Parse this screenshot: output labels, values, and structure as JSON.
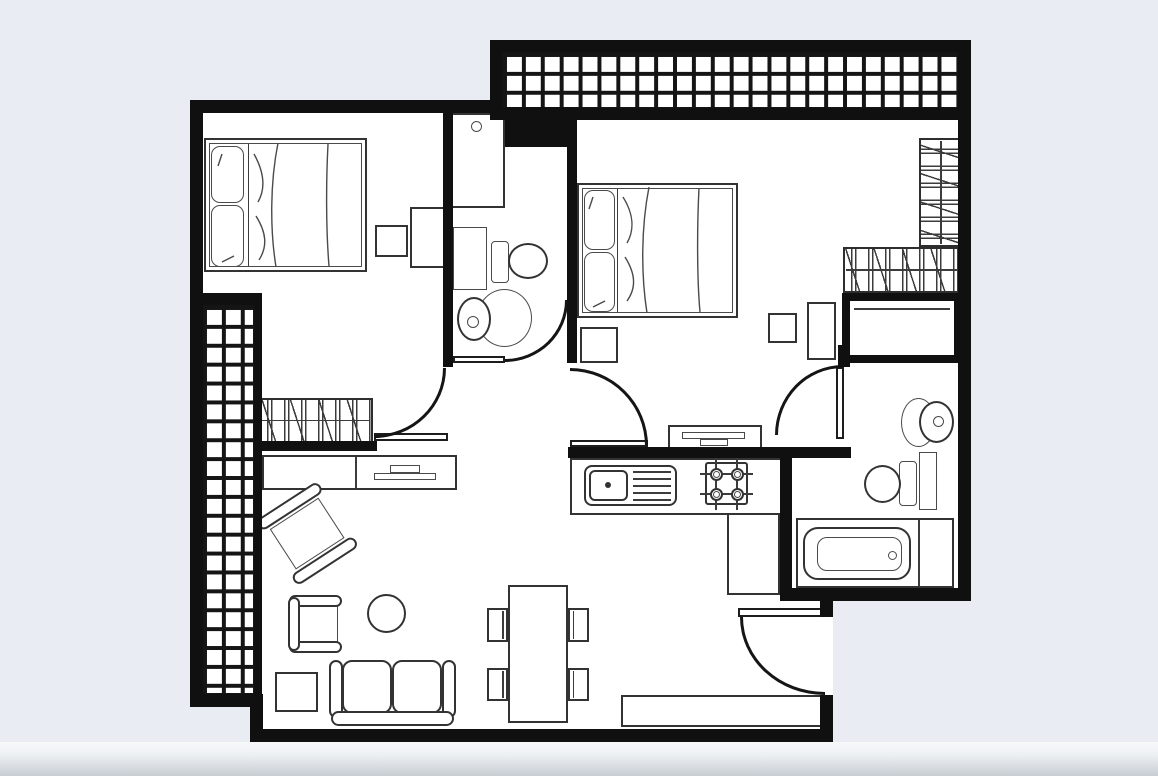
{
  "canvas": {
    "width": 1158,
    "height": 776,
    "background_color": "#e9edf3",
    "floor_color": "#ffffff",
    "wall_color": "#101010",
    "furniture_line_color": "#3c3c3c",
    "bottom_band": [
      0,
      742,
      1158,
      34
    ]
  },
  "rooms": [
    "bedroom-left",
    "bedroom-right",
    "bathroom",
    "wc",
    "kitchen",
    "living-dining-room",
    "hall",
    "balcony-top",
    "balcony-left",
    "entrance"
  ],
  "plan": {
    "floor_rects": [
      [
        190,
        100,
        781,
        501
      ],
      [
        490,
        40,
        481,
        80
      ],
      [
        190,
        601,
        643,
        106
      ],
      [
        250,
        707,
        583,
        35
      ]
    ],
    "walls": [
      [
        190,
        100,
        312,
        13
      ],
      [
        190,
        100,
        13,
        607
      ],
      [
        190,
        694,
        73,
        13
      ],
      [
        250,
        707,
        13,
        35
      ],
      [
        250,
        729,
        583,
        13
      ],
      [
        820,
        695,
        13,
        47
      ],
      [
        820,
        601,
        13,
        16
      ],
      [
        780,
        588,
        191,
        13
      ],
      [
        780,
        451,
        12,
        150
      ],
      [
        958,
        40,
        13,
        561
      ],
      [
        490,
        40,
        481,
        12
      ],
      [
        490,
        40,
        12,
        80
      ],
      [
        502,
        108,
        456,
        12
      ],
      [
        443,
        113,
        10,
        254
      ],
      [
        567,
        113,
        10,
        250
      ],
      [
        259,
        441,
        118,
        10
      ],
      [
        568,
        447,
        283,
        11
      ],
      [
        838,
        345,
        12,
        22
      ],
      [
        202,
        293,
        60,
        12
      ],
      [
        254,
        303,
        8,
        391
      ],
      [
        505,
        107,
        68,
        40
      ]
    ],
    "tiled_areas": [
      {
        "name": "balcony-top-tiles",
        "rect": [
          502,
          52,
          456,
          56
        ]
      },
      {
        "name": "balcony-left-tiles",
        "rect": [
          202,
          305,
          52,
          389
        ]
      }
    ],
    "hatched_units": [
      {
        "name": "bookshelf",
        "rect": [
          259,
          398,
          114,
          45
        ],
        "orient": "h"
      },
      {
        "name": "wardrobe-vertical",
        "rect": [
          919,
          138,
          44,
          109
        ],
        "orient": "v"
      },
      {
        "name": "wardrobe-horizontal",
        "rect": [
          843,
          247,
          120,
          46
        ],
        "orient": "h"
      }
    ],
    "doors": [
      {
        "name": "bedroom-left-door",
        "arc": [
          374,
          368,
          72,
          70
        ],
        "corner": "br",
        "leaf": [
          374,
          433,
          74,
          8
        ]
      },
      {
        "name": "wc-door",
        "arc": [
          505,
          300,
          63,
          62
        ],
        "corner": "br",
        "leaf": [
          453,
          356,
          52,
          7
        ]
      },
      {
        "name": "bedroom-right-door",
        "arc": [
          570,
          368,
          78,
          78
        ],
        "corner": "tr",
        "leaf": [
          570,
          440,
          78,
          7
        ]
      },
      {
        "name": "bathroom-door",
        "arc": [
          775,
          365,
          68,
          70
        ],
        "corner": "tl",
        "leaf": [
          836,
          367,
          8,
          72
        ]
      },
      {
        "name": "entrance-door",
        "arc": [
          740,
          617,
          85,
          78
        ],
        "corner": "bl",
        "leaf": [
          738,
          608,
          87,
          9
        ]
      }
    ],
    "furniture": [
      {
        "type": "bed",
        "name": "bed-left",
        "rect": [
          204,
          138,
          163,
          134
        ],
        "divider_x": 44,
        "pillows": [
          [
            7,
            8,
            33,
            57
          ],
          [
            7,
            67,
            33,
            62
          ]
        ],
        "folds": [
          "M74 5 C66 45 66 92 72 129",
          "M124 6 C122 45 122 92 125 128",
          "M50 16 C60 34 62 50 54 64",
          "M52 78 C62 94 64 108 55 122",
          "M18 16 L14 28",
          "M30 118 L18 124"
        ]
      },
      {
        "type": "bed",
        "name": "bed-right",
        "rect": [
          577,
          183,
          161,
          135
        ],
        "divider_x": 40,
        "pillows": [
          [
            7,
            7,
            31,
            60
          ],
          [
            7,
            69,
            31,
            60
          ]
        ],
        "folds": [
          "M72 4 C64 45 64 92 70 130",
          "M122 5 C120 45 120 96 123 129",
          "M46 14 C56 30 58 46 50 60",
          "M48 74 C58 90 60 104 50 118",
          "M16 14 L12 26",
          "M28 118 L16 124"
        ]
      },
      {
        "type": "box",
        "name": "nightstand",
        "rect": [
          375,
          225,
          33,
          32
        ]
      },
      {
        "type": "box",
        "name": "dresser",
        "rect": [
          410,
          207,
          35,
          61
        ]
      },
      {
        "type": "box",
        "name": "nightstand",
        "rect": [
          580,
          327,
          38,
          36
        ]
      },
      {
        "type": "box",
        "name": "stool",
        "rect": [
          768,
          313,
          29,
          30
        ]
      },
      {
        "type": "box",
        "name": "side-table",
        "rect": [
          807,
          302,
          29,
          58
        ]
      },
      {
        "type": "box",
        "name": "square-table",
        "rect": [
          275,
          672,
          43,
          40
        ]
      },
      {
        "type": "box",
        "name": "entry-console",
        "rect": [
          621,
          695,
          206,
          32
        ]
      },
      {
        "type": "washer",
        "name": "washing-machine",
        "rect": [
          447,
          113,
          58,
          95
        ],
        "dot": [
          471,
          121,
          11,
          11
        ]
      },
      {
        "type": "duct",
        "name": "duct",
        "rect": [
          453,
          227,
          34,
          63
        ]
      },
      {
        "type": "duct",
        "name": "duct",
        "rect": [
          919,
          452,
          18,
          58
        ]
      },
      {
        "type": "toilet",
        "name": "toilet-wc",
        "tank": [
          491,
          241,
          18,
          42
        ],
        "bowl": [
          508,
          243,
          40,
          36
        ]
      },
      {
        "type": "toilet",
        "name": "toilet-bathroom",
        "tank": [
          899,
          461,
          18,
          45
        ],
        "bowl": [
          864,
          465,
          37,
          38
        ]
      },
      {
        "type": "sink",
        "name": "sink-wc",
        "pedestal": [
          477,
          289,
          55,
          58
        ],
        "basin": [
          457,
          297,
          34,
          44
        ],
        "dot": [
          467,
          316,
          12,
          12
        ]
      },
      {
        "type": "sink",
        "name": "sink-bathroom",
        "pedestal": [
          901,
          398,
          35,
          49
        ],
        "basin": [
          919,
          401,
          35,
          42
        ],
        "dot": [
          933,
          416,
          11,
          11
        ]
      },
      {
        "type": "tub",
        "name": "bathtub",
        "outer": [
          796,
          518,
          158,
          70
        ],
        "divider_x": 918,
        "shell": [
          803,
          527,
          108,
          53
        ],
        "inner": [
          817,
          537,
          85,
          34
        ],
        "drain": [
          888,
          551,
          9,
          9
        ]
      },
      {
        "type": "counter",
        "name": "kitchen-counter",
        "rects": [
          [
            570,
            458,
            213,
            57
          ],
          [
            727,
            513,
            53,
            82
          ]
        ]
      },
      {
        "type": "ksink",
        "name": "kitchen-sink",
        "outer": [
          584,
          465,
          93,
          41
        ],
        "basin": [
          589,
          470,
          39,
          31
        ],
        "dot": [
          605,
          482,
          6,
          6
        ],
        "drain": {
          "x": 633,
          "w": 38,
          "ys": [
            471,
            478,
            485,
            492,
            499
          ]
        }
      },
      {
        "type": "stove",
        "name": "stove",
        "rect": [
          705,
          462,
          43,
          43
        ],
        "centers": [
          [
            716,
            474
          ],
          [
            737,
            474
          ],
          [
            716,
            494
          ],
          [
            737,
            494
          ]
        ],
        "r_out": 6.5,
        "r_in": 3.5
      },
      {
        "type": "closet",
        "name": "closet",
        "rect": [
          842,
          293,
          120,
          70
        ]
      },
      {
        "type": "sideboard",
        "name": "tv-sideboard",
        "rect": [
          262,
          455,
          195,
          35
        ],
        "divider_x": 355,
        "tv_small": [
          390,
          465,
          30,
          8
        ],
        "tv_bar": [
          374,
          473,
          62,
          7
        ]
      },
      {
        "type": "tvpanel",
        "name": "tv-panel",
        "rect": [
          668,
          425,
          94,
          28
        ],
        "bar": [
          682,
          432,
          63,
          7
        ],
        "small": [
          700,
          439,
          28,
          7
        ]
      },
      {
        "type": "sofa",
        "name": "sofa",
        "rect": [
          330,
          658,
          125,
          68
        ]
      },
      {
        "type": "armchair-u",
        "name": "armchair",
        "rect": [
          288,
          595,
          56,
          58
        ]
      },
      {
        "type": "armchair-rot",
        "name": "armchair-rotated",
        "rect": [
          266,
          492,
          84,
          82
        ],
        "angle": -33
      },
      {
        "type": "circle",
        "name": "round-table",
        "rect": [
          367,
          594,
          39,
          39
        ]
      },
      {
        "type": "table",
        "name": "dining-table",
        "rect": [
          508,
          585,
          60,
          138
        ]
      },
      {
        "type": "chair",
        "name": "dining-chair",
        "rect": [
          487,
          608,
          21,
          34
        ],
        "side": "right"
      },
      {
        "type": "chair",
        "name": "dining-chair",
        "rect": [
          487,
          668,
          21,
          33
        ],
        "side": "right"
      },
      {
        "type": "chair",
        "name": "dining-chair",
        "rect": [
          568,
          608,
          21,
          34
        ],
        "side": "left"
      },
      {
        "type": "chair",
        "name": "dining-chair",
        "rect": [
          568,
          668,
          21,
          33
        ],
        "side": "left"
      }
    ]
  }
}
